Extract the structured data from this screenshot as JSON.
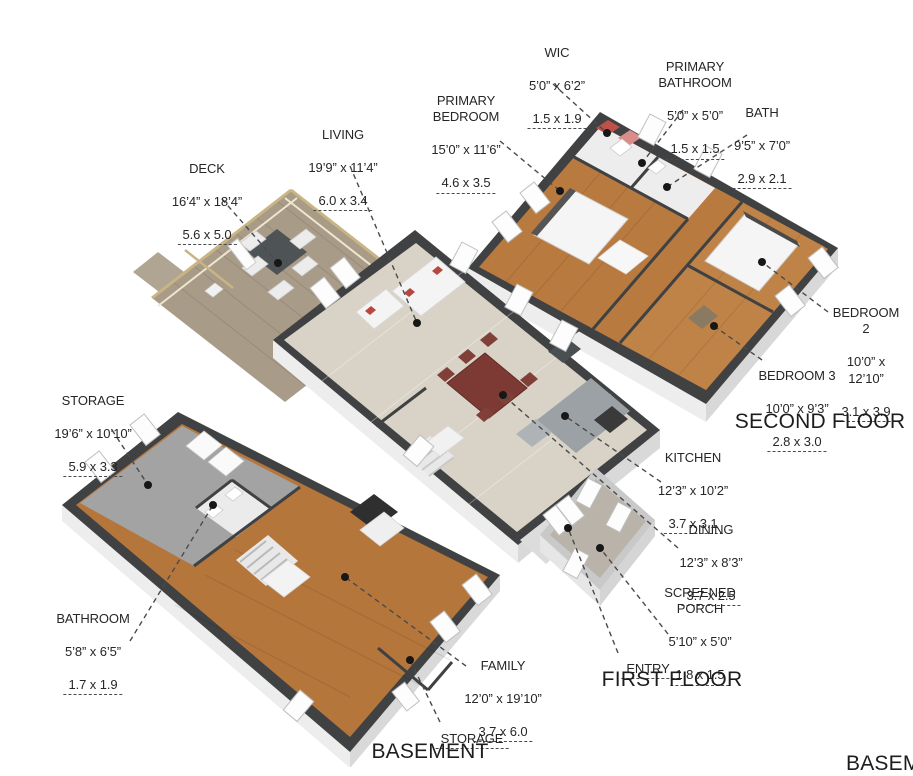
{
  "titles": {
    "second": "SECOND FLOOR",
    "first": "FIRST FLOOR",
    "basement": "BASEMENT",
    "basement_partial": "BASEMENT"
  },
  "labels": {
    "wic": {
      "name": "WIC",
      "imperial": "5’0” x 6’2”",
      "metric": "1.5 x 1.9"
    },
    "primary_bathroom": {
      "name": "PRIMARY\nBATHROOM",
      "imperial": "5’0” x 5’0”",
      "metric": "1.5 x 1.5"
    },
    "primary_bedroom": {
      "name": "PRIMARY\nBEDROOM",
      "imperial": "15’0” x 11’6”",
      "metric": "4.6 x 3.5"
    },
    "bath": {
      "name": "BATH",
      "imperial": "9’5” x 7’0”",
      "metric": "2.9 x 2.1"
    },
    "living": {
      "name": "LIVING",
      "imperial": "19’9” x 11’4”",
      "metric": "6.0 x 3.4"
    },
    "deck": {
      "name": "DECK",
      "imperial": "16’4” x 18’4”",
      "metric": "5.6 x 5.0"
    },
    "bedroom2": {
      "name": "BEDROOM 2",
      "imperial": "10’0” x 12’10”",
      "metric": "3.1 x 3.9"
    },
    "bedroom3": {
      "name": "BEDROOM 3",
      "imperial": "10’0” x 9’3”",
      "metric": "2.8 x 3.0"
    },
    "storage_left": {
      "name": "STORAGE",
      "imperial": "19’6” x 10’10”",
      "metric": "5.9 x 3.3"
    },
    "kitchen": {
      "name": "KITCHEN",
      "imperial": "12’3” x 10’2”",
      "metric": "3.7 x 3.1"
    },
    "dining": {
      "name": "DINING",
      "imperial": "12’3” x 8’3”",
      "metric": "3.7 x 2.5"
    },
    "screened_porch": {
      "name": "SCREENED\nPORCH",
      "imperial": "5’10” x 5’0”",
      "metric": "1.8 x 1.5"
    },
    "bathroom": {
      "name": "BATHROOM",
      "imperial": "5’8” x 6’5”",
      "metric": "1.7 x 1.9"
    },
    "family": {
      "name": "FAMILY",
      "imperial": "12’0” x 19’10”",
      "metric": "3.7 x 6.0"
    },
    "entry": {
      "name": "ENTRY"
    },
    "storage_bottom": {
      "name": "STORAGE"
    }
  },
  "palette": {
    "wall": "#3f4142",
    "wood_dark": "#b5763c",
    "wood_second": "#b97a40",
    "wood_light": "#d9d2c6",
    "deck_wood": "#a89b88",
    "concrete": "#a3a3a3",
    "accent_red": "#b8473f",
    "table_maroon": "#7d3a34",
    "leader_line": "#4a4a4a",
    "text": "#262626"
  }
}
